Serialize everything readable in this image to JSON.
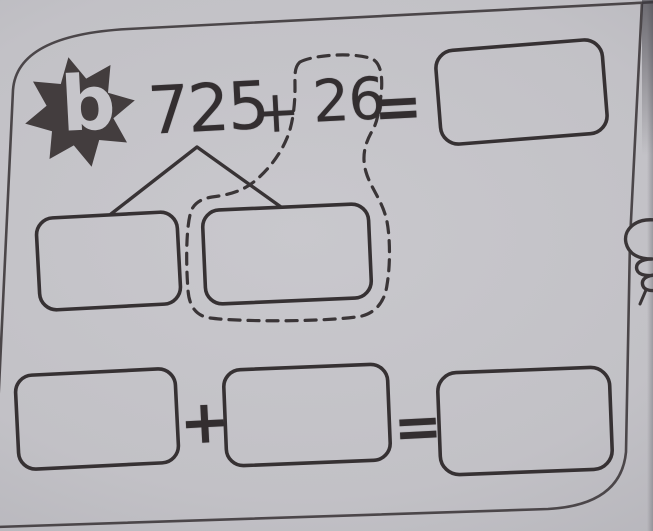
{
  "problem": {
    "label": "b",
    "equation": {
      "addend1": "725",
      "operator": "+",
      "addend2": "26",
      "equals_sign": "=",
      "answer_value": ""
    },
    "decomposition": {
      "left_box_value": "",
      "right_box_value": ""
    },
    "expanded_equation": {
      "first_value": "",
      "operator": "+",
      "second_value": "",
      "equals_sign": "=",
      "result_value": ""
    }
  },
  "icons": {
    "label_badge": "starburst-icon",
    "page_doodle": "cartoon-hand-icon"
  },
  "colors": {
    "paper": "#c2c1c6",
    "ink": "#393436",
    "badge_fill": "#433d3e",
    "badge_letter": "#c6c5ca"
  }
}
